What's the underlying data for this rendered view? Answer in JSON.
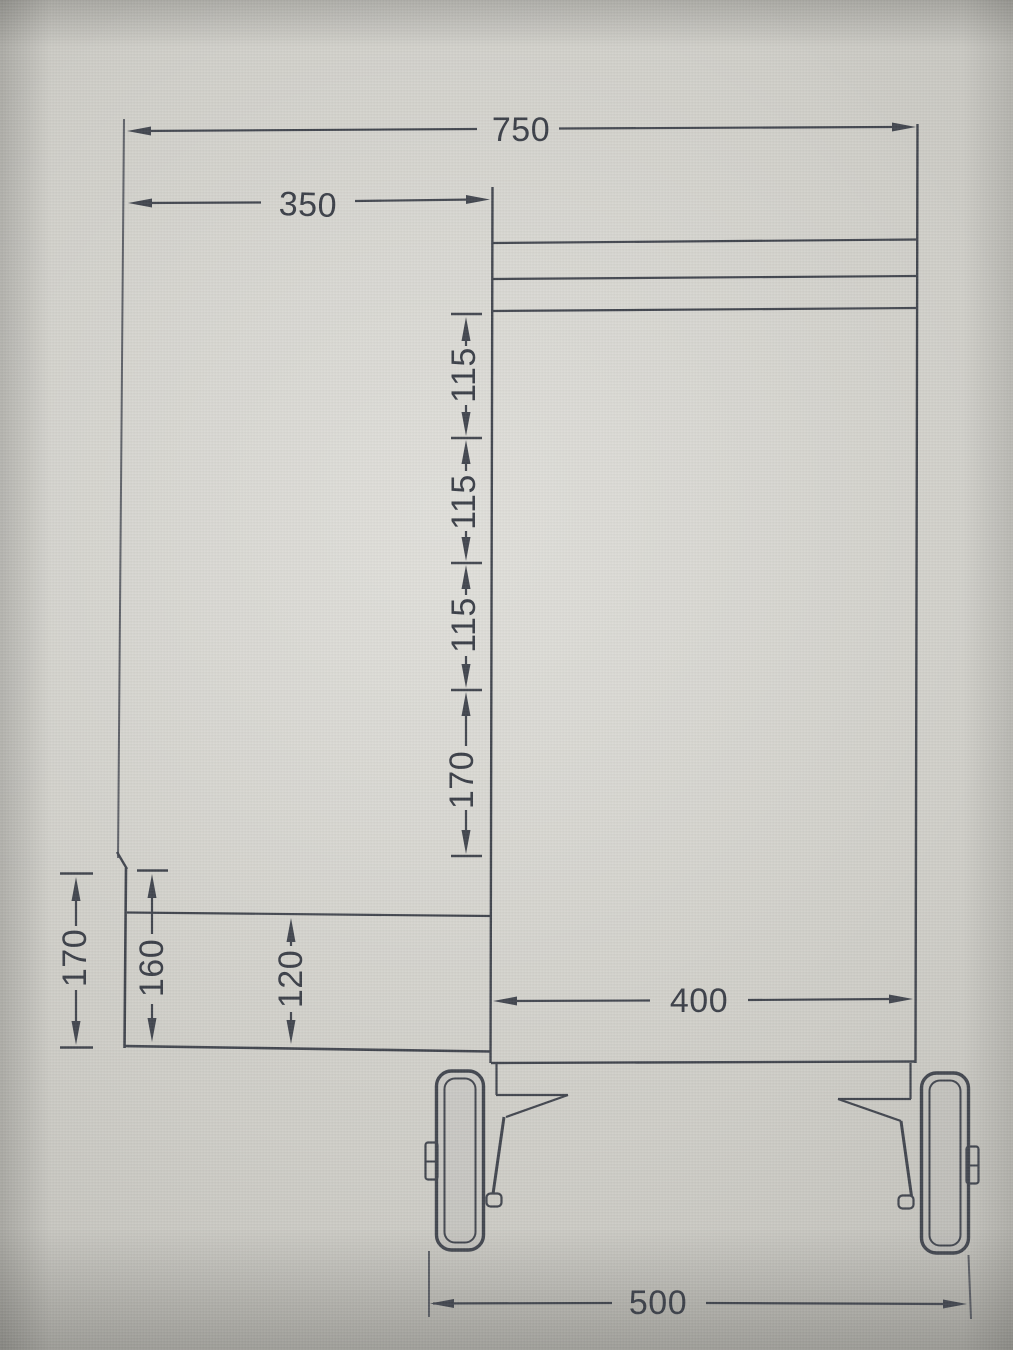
{
  "colors": {
    "ink": "#42464f",
    "text": "#3b3f48",
    "paper_center": "#d8d7d1",
    "paper_edge": "#93928c"
  },
  "labels": {
    "overall_width": "750",
    "left_section_width": "350",
    "pitch_1": "115",
    "pitch_2": "115",
    "pitch_3": "115",
    "pitch_4": "170",
    "left_height_outer": "170",
    "left_height_inner": "160",
    "shelf_gap": "120",
    "body_depth": "400",
    "wheel_span": "500"
  }
}
